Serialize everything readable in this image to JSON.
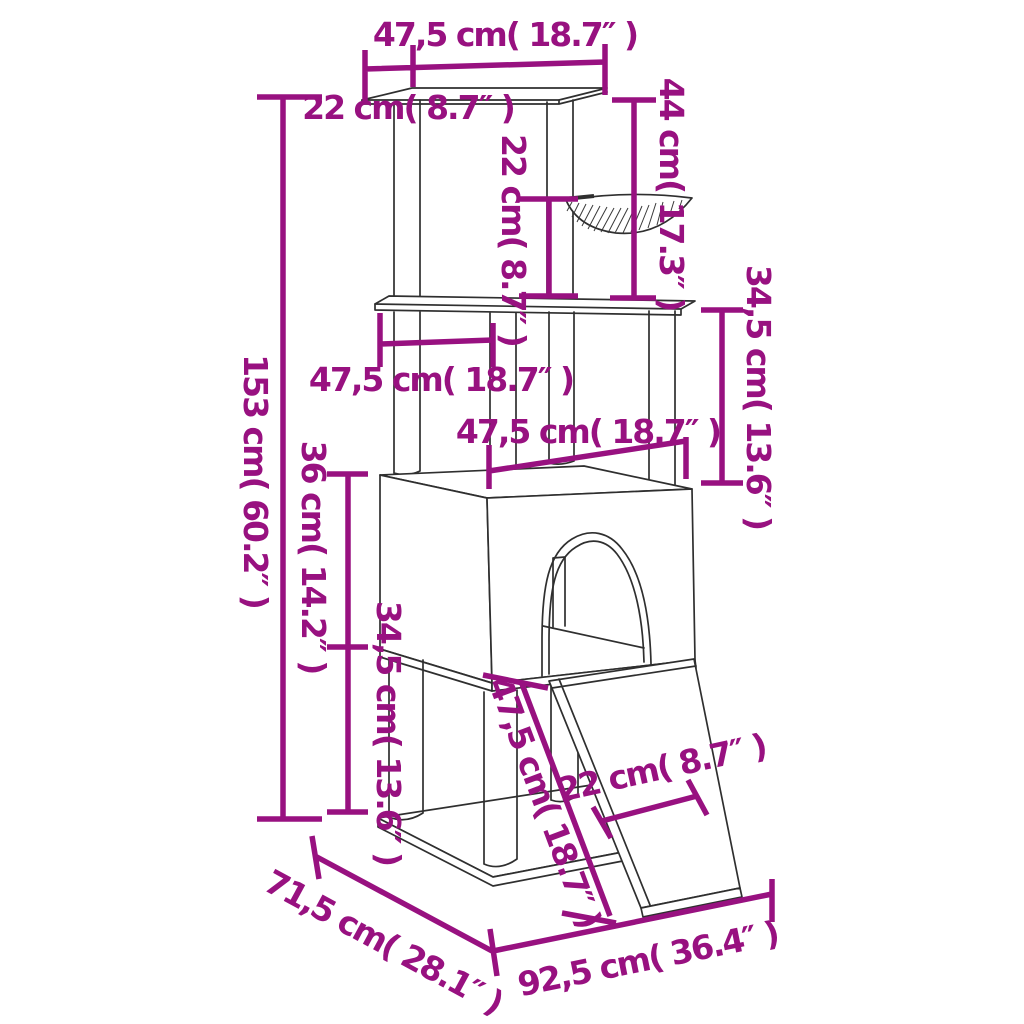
{
  "background_color": "#ffffff",
  "diagram": {
    "type": "product-dimension-drawing",
    "subject": "cat tree with scratching posts, hammock, condo house and ramp",
    "dimension_color": "#981180",
    "drawing_color": "#2f2f2f",
    "units": [
      "cm",
      "inch"
    ],
    "dimensions": [
      {
        "id": "top-platform-width",
        "label": "47,5 cm( 18.7″ )"
      },
      {
        "id": "top-platform-depth",
        "label": "22 cm( 8.7″ )"
      },
      {
        "id": "total-height",
        "label": "153 cm( 60.2″ )"
      },
      {
        "id": "hammock-to-platform-height",
        "label": "22 cm( 8.7″ )"
      },
      {
        "id": "top-section-height",
        "label": "44 cm( 17.3″ )"
      },
      {
        "id": "upper-section-height",
        "label": "34,5 cm( 13.6″ )"
      },
      {
        "id": "middle-platform-width",
        "label": "47,5 cm( 18.7″ )"
      },
      {
        "id": "condo-width",
        "label": "47,5 cm( 18.7″ )"
      },
      {
        "id": "condo-height",
        "label": "36 cm( 14.2″ )"
      },
      {
        "id": "lower-section-height",
        "label": "34,5 cm( 13.6″ )"
      },
      {
        "id": "ramp-length",
        "label": "47,5 cm( 18.7″ )"
      },
      {
        "id": "ramp-width",
        "label": "22 cm( 8.7″ )"
      },
      {
        "id": "base-depth",
        "label": "71,5 cm( 28.1″ )"
      },
      {
        "id": "base-width",
        "label": "92,5 cm( 36.4″ )"
      }
    ]
  }
}
